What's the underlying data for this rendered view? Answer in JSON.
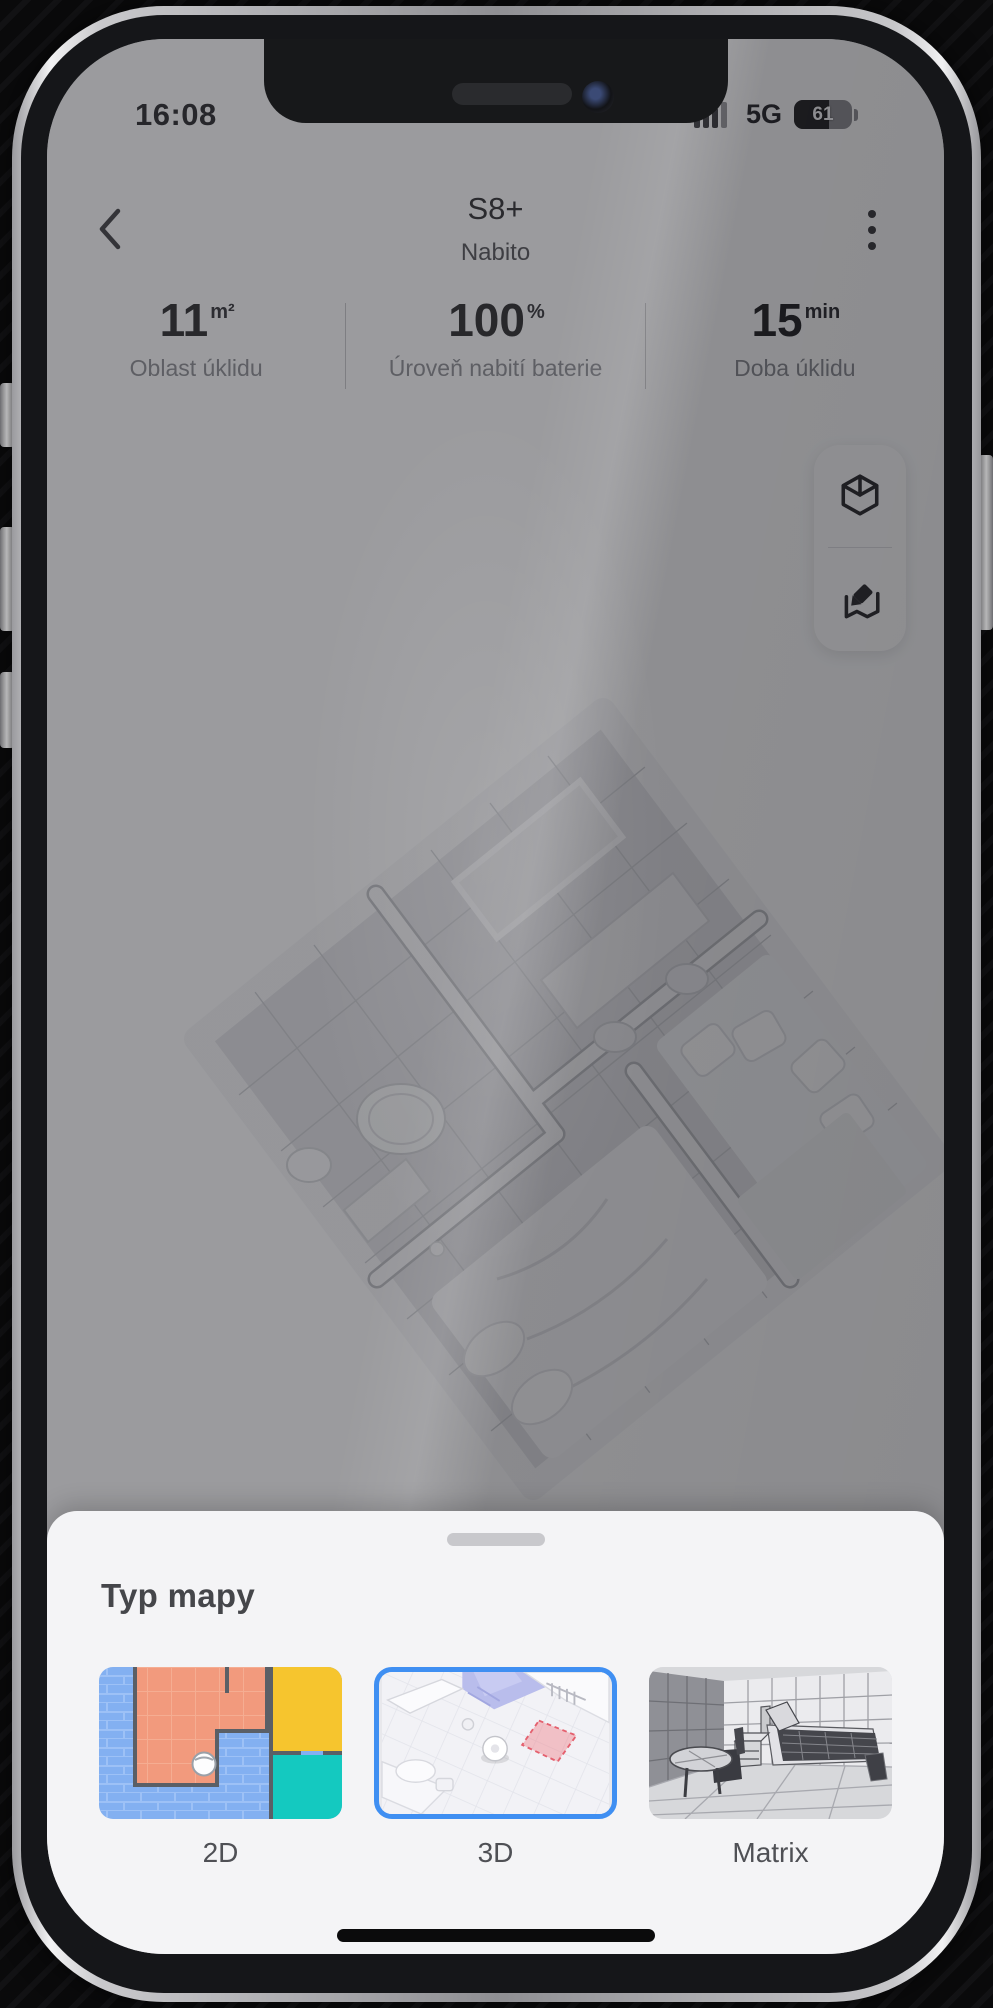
{
  "status_bar": {
    "time": "16:08",
    "signal_icon": "cellular-signal",
    "network": "5G",
    "battery_percent": "61"
  },
  "header": {
    "back_icon": "chevron-left",
    "title": "S8+",
    "subtitle": "Nabito",
    "menu_icon": "kebab-menu"
  },
  "stats": {
    "area": {
      "value": "11",
      "unit": "m²",
      "label": "Oblast úklidu"
    },
    "battery": {
      "value": "100",
      "unit": "%",
      "label": "Úroveň nabití baterie"
    },
    "time": {
      "value": "15",
      "unit": "min",
      "label": "Doba úklidu"
    }
  },
  "map_toolbar": {
    "view_3d_icon": "cube-3d",
    "edit_icon": "map-edit"
  },
  "bottom_sheet": {
    "title": "Typ mapy",
    "options": [
      {
        "label": "2D",
        "selected": false
      },
      {
        "label": "3D",
        "selected": true
      },
      {
        "label": "Matrix",
        "selected": false
      }
    ]
  },
  "colors": {
    "accent": "#3f8ff2",
    "sheet_bg": "#f4f4f6",
    "dim_overlay": "rgba(18,18,23,0.42)",
    "map2d_floor_blue": "#83b0f1",
    "map2d_room_salmon": "#f29a7d",
    "map2d_room_yellow": "#f6c52e",
    "map2d_room_teal": "#14c9c0",
    "map3d_room_purple": "#b9bdec",
    "map3d_zone_red": "#ef808c"
  }
}
